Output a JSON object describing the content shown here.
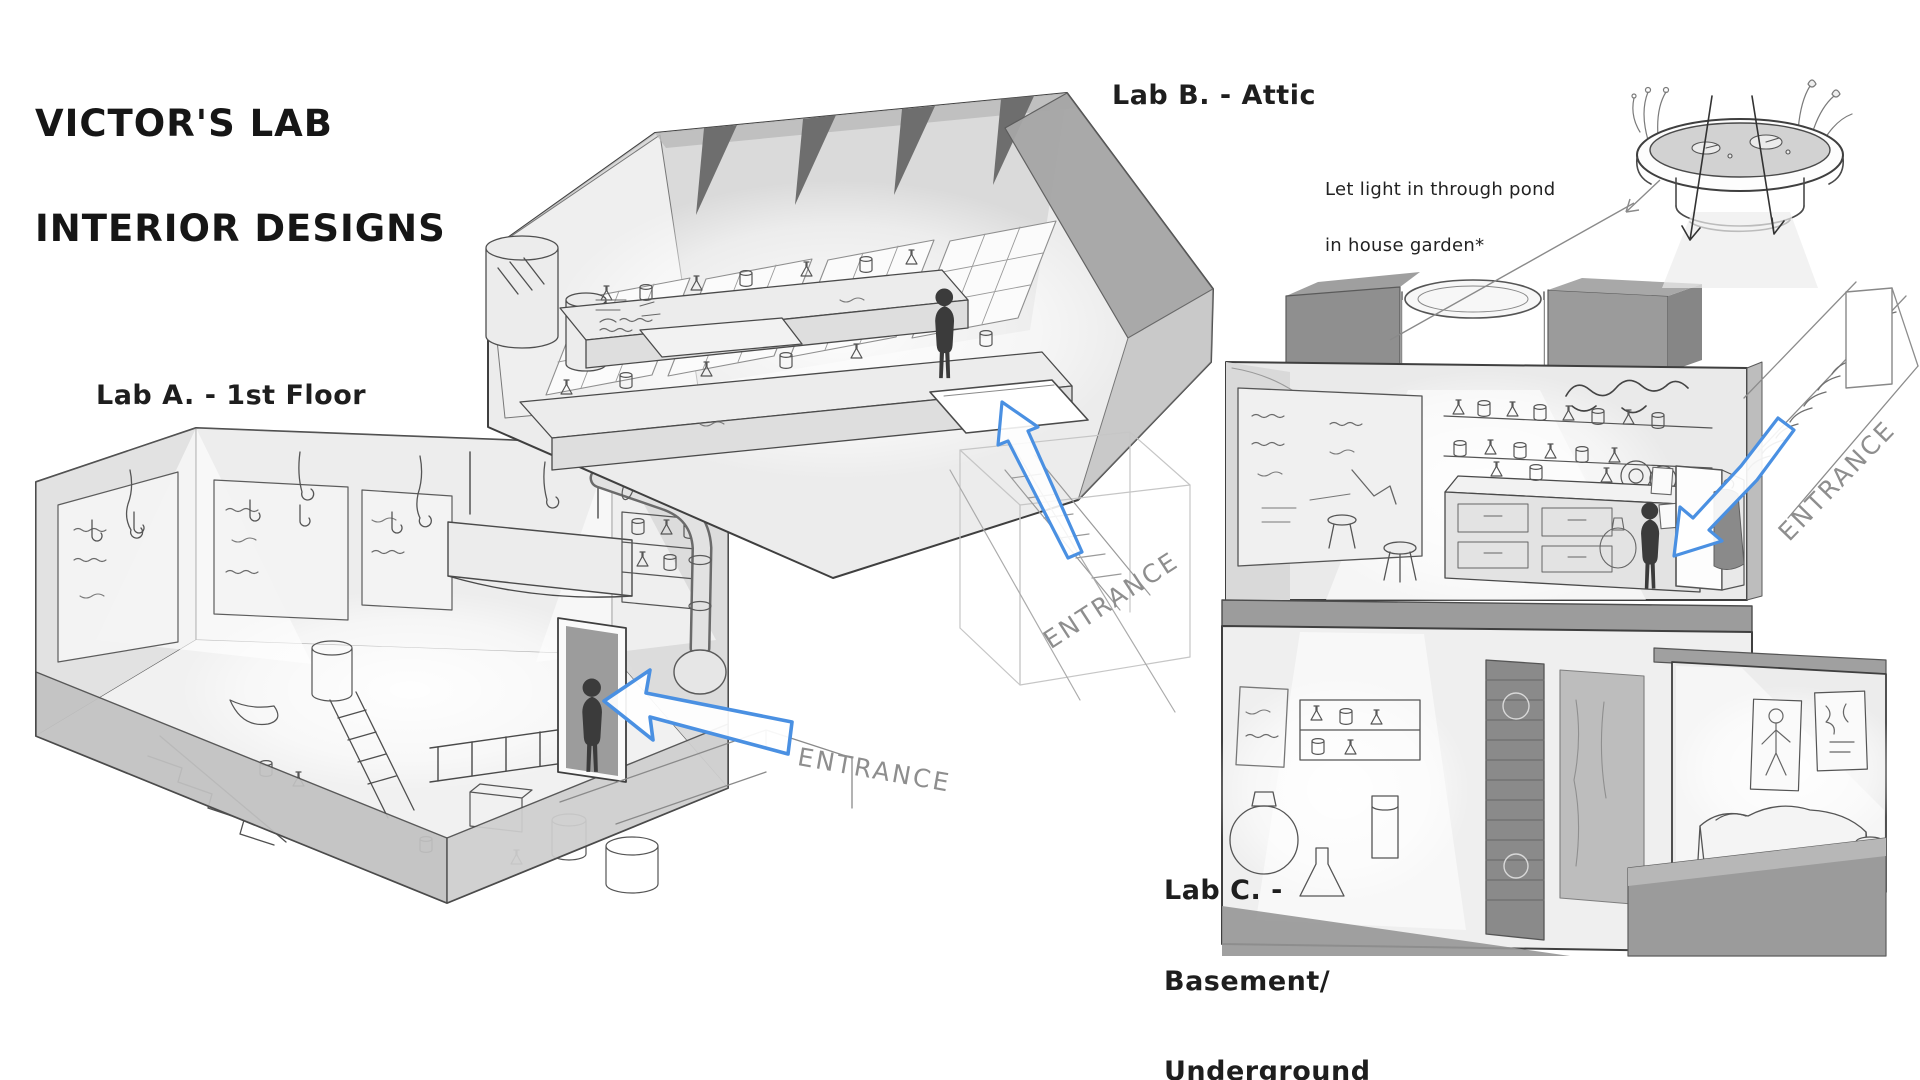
{
  "page": {
    "title_line1": "VICTOR'S LAB",
    "title_line2": "INTERIOR DESIGNS"
  },
  "labels": {
    "lab_a": "Lab A. - 1st Floor",
    "lab_b": "Lab B. - Attic",
    "lab_c_line1": "Lab C. -",
    "lab_c_line2": "Basement/",
    "lab_c_line3": "Underground"
  },
  "annotations": {
    "pond_note_line1": "Let light in through pond",
    "pond_note_line2": "in house garden*",
    "entrance_a": "ENTRANCE",
    "entrance_b": "ENTRANCE",
    "entrance_c": "ENTRANCE"
  },
  "colors": {
    "accent_blue": "#4a90e2",
    "ink": "#3f3f3f",
    "muted_text": "#8e8e8e",
    "wall_gray": "#b3b3b3",
    "roof_gray": "#a6a6a6"
  }
}
